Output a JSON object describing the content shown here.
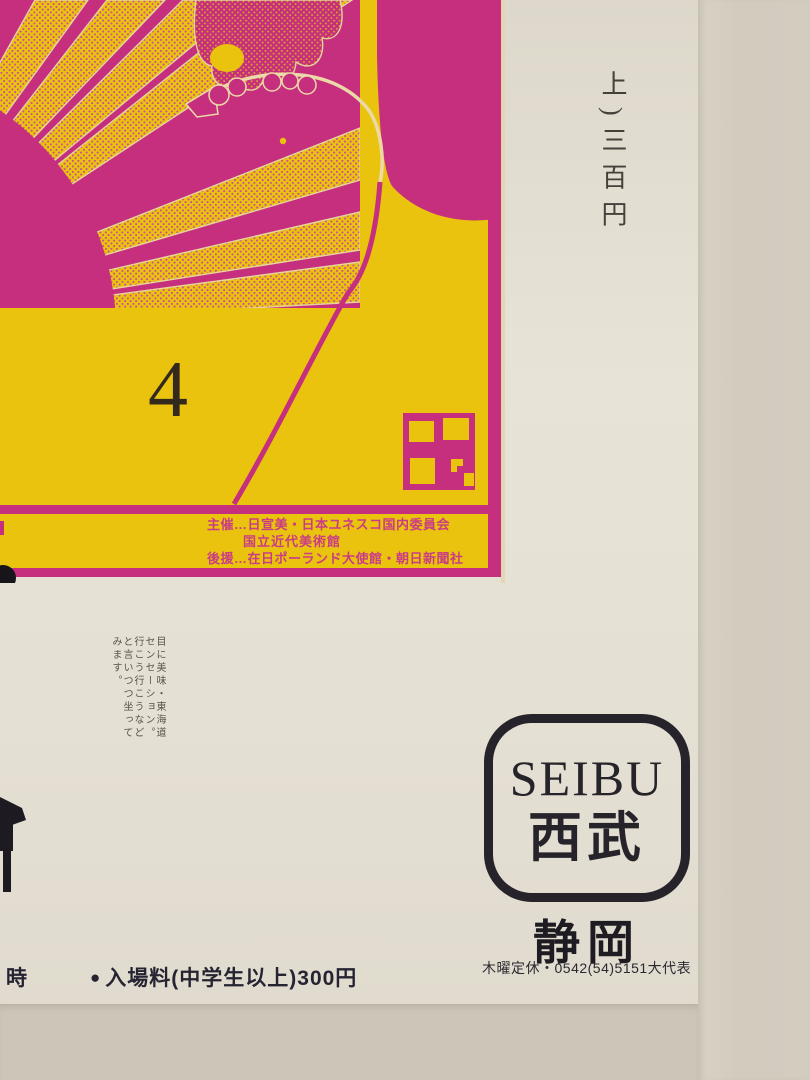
{
  "poster": {
    "artwork": {
      "number_label": "4",
      "credits": [
        "主催…日宣美・日本ユネスコ国内委員会",
        "国立近代美術館",
        "後援…在日ポーランド大使館・朝日新聞社"
      ],
      "colors": {
        "yellow": "#e9c30d",
        "magenta": "#c62f7e"
      }
    },
    "price_note_vertical": "上)三百円",
    "copy_text_vertical": "目に美味・東海道センセーション。行こう行こうなどと言いつつ坐ってみます。",
    "retailer": {
      "logo_latin": "SEIBU",
      "logo_kanji": "西武",
      "store_name": "静岡",
      "store_info": "木曜定休・0542(54)5151大代表"
    },
    "admission": {
      "left_partial": "時",
      "bullet": "●",
      "text": "入場料(中学生以上)300円"
    }
  }
}
